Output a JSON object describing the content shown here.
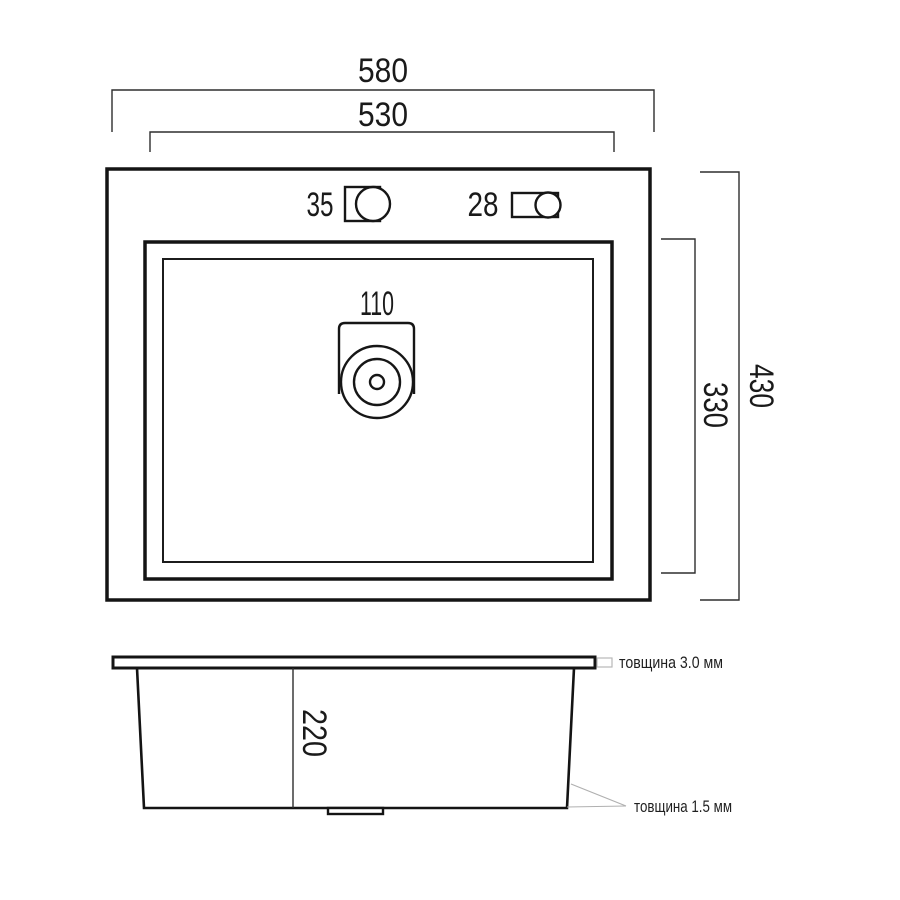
{
  "drawing": {
    "title": "sink-technical-drawing",
    "top_view": {
      "dim_width_outer": "580",
      "dim_width_inner": "530",
      "dim_height_outer": "430",
      "dim_height_inner": "330",
      "hole_left_diameter": "35",
      "hole_right_diameter": "28",
      "drain_diameter": "110"
    },
    "side_view": {
      "dim_depth": "220",
      "note_rim_thickness": "товщина 3.0 мм",
      "note_wall_thickness": "товщина 1.5 мм"
    },
    "colors": {
      "background": "#ffffff",
      "main_line": "#141414",
      "dimension_line": "#2e2e2e",
      "leader_line": "#b0b0b0",
      "text": "#1a1a1a"
    }
  }
}
